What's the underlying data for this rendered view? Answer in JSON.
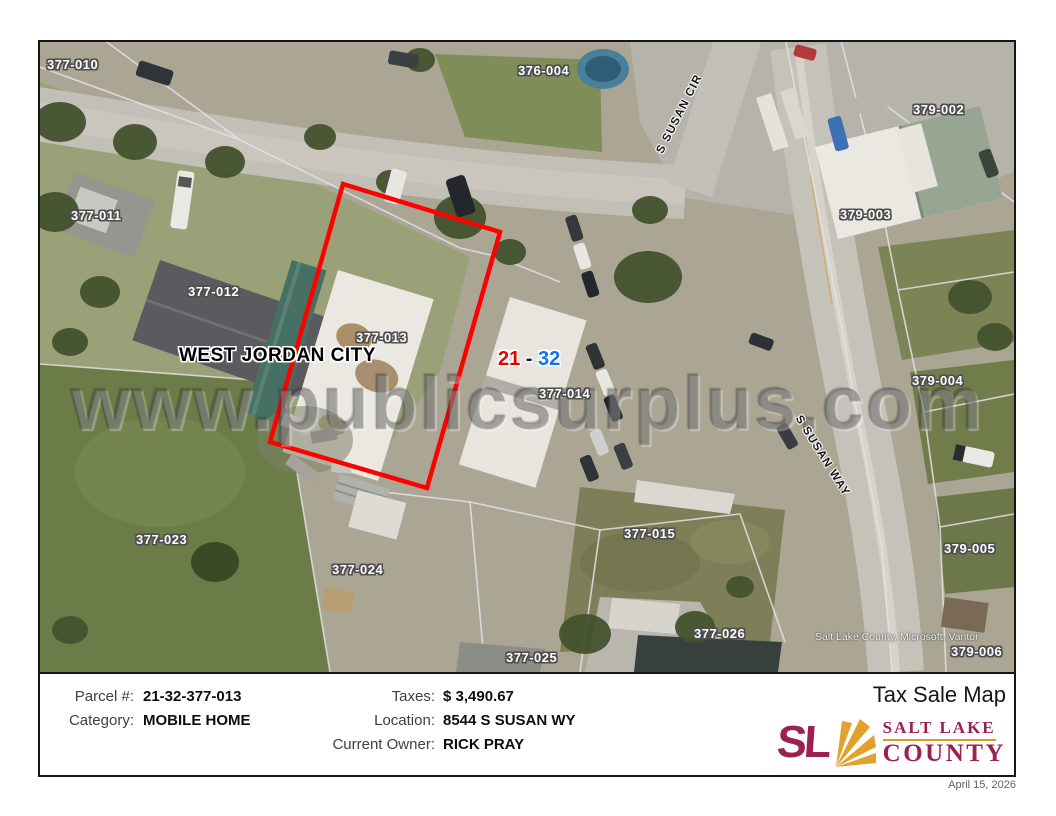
{
  "header": {
    "title": "Tax Sale Map",
    "date": "April 15, 2026"
  },
  "map": {
    "watermark": "www.publicsurplus.com",
    "city_label": "WEST JORDAN CITY",
    "range": {
      "from": "21",
      "sep": " - ",
      "to": "32"
    },
    "attribution": "Salt Lake County, Microsoft, Vantor",
    "highlighted_parcel": "377-013",
    "streets": [
      {
        "name": "S SUSAN CIR"
      },
      {
        "name": "S SUSAN WAY"
      }
    ],
    "parcels": [
      {
        "id": "377-010",
        "x": 7,
        "y": 15
      },
      {
        "id": "376-004",
        "x": 478,
        "y": 21
      },
      {
        "id": "379-002",
        "x": 873,
        "y": 60
      },
      {
        "id": "377-011",
        "x": 31,
        "y": 166
      },
      {
        "id": "379-003",
        "x": 800,
        "y": 165
      },
      {
        "id": "377-012",
        "x": 148,
        "y": 242
      },
      {
        "id": "377-013",
        "x": 316,
        "y": 288
      },
      {
        "id": "377-014",
        "x": 499,
        "y": 344
      },
      {
        "id": "379-004",
        "x": 872,
        "y": 331
      },
      {
        "id": "377-023",
        "x": 96,
        "y": 490
      },
      {
        "id": "377-024",
        "x": 292,
        "y": 520
      },
      {
        "id": "377-015",
        "x": 584,
        "y": 484
      },
      {
        "id": "379-005",
        "x": 904,
        "y": 499
      },
      {
        "id": "377-026",
        "x": 654,
        "y": 584
      },
      {
        "id": "377-025",
        "x": 466,
        "y": 608
      },
      {
        "id": "379-006",
        "x": 911,
        "y": 602
      }
    ]
  },
  "details": {
    "fields": [
      {
        "label": "Parcel #:",
        "value": "21-32-377-013"
      },
      {
        "label": "Category:",
        "value": "MOBILE HOME"
      },
      {
        "label": "Taxes:",
        "value": "$ 3,490.67"
      },
      {
        "label": "Location:",
        "value": "8544 S SUSAN WY"
      },
      {
        "label": "Current Owner:",
        "value": "RICK PRAY"
      }
    ]
  },
  "logo": {
    "mark": "SL",
    "line1": "SALT LAKE",
    "line2": "COUNTY"
  },
  "colors": {
    "highlight_outline": "#ff0000",
    "range_from": "#e60000",
    "range_to": "#1473e6",
    "logo_maroon": "#9b2150",
    "logo_gold": "#dd9c27"
  }
}
